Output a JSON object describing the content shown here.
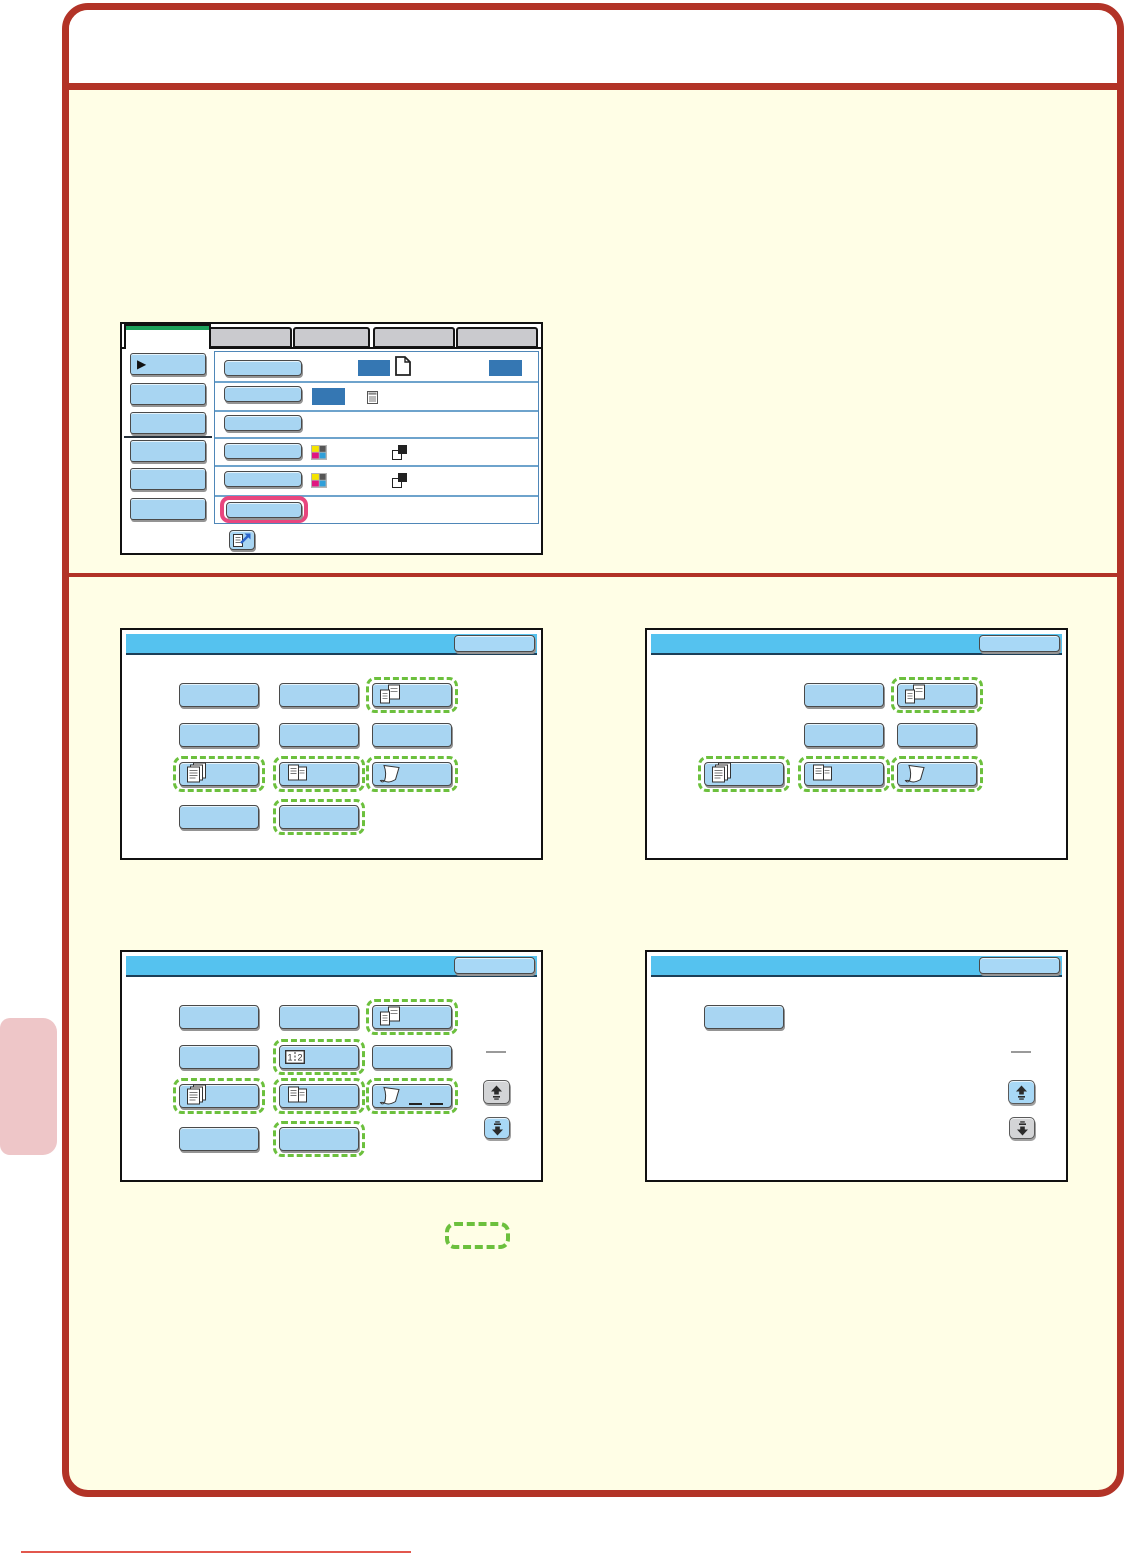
{
  "document": {
    "type": "copier-operation-manual-page",
    "header_title": "",
    "colors": {
      "red": "#b23327",
      "cream": "#fffee6",
      "sky": "#55c2ef",
      "btnblue": "#a8d5f2",
      "okblue": "#a8d8f6",
      "darkblue": "#3577b3",
      "tabgray": "#cacace",
      "green": "#1ca05a",
      "dashgreen": "#6cc03d",
      "pink": "#e8467e",
      "tabpink": "#eec6c8",
      "footer": "#e2574d",
      "disgray": "#d3d4d6"
    }
  },
  "settings_screen": {
    "tabs": [
      {
        "label": "",
        "active": true
      },
      {
        "label": "",
        "active": false
      },
      {
        "label": "",
        "active": false
      },
      {
        "label": "",
        "active": false
      },
      {
        "label": "",
        "active": false
      }
    ],
    "sidebar_keys": [
      {
        "label": "",
        "selected": true
      },
      {
        "label": ""
      },
      {
        "label": ""
      },
      {
        "label": ""
      },
      {
        "label": ""
      },
      {
        "label": ""
      }
    ],
    "rows": [
      {
        "key_label": "",
        "value_boxes": 2,
        "icons": [
          "blank-page"
        ]
      },
      {
        "key_label": "",
        "value_boxes": 1,
        "icons": [
          "document-list"
        ]
      },
      {
        "key_label": "",
        "value_boxes": 0,
        "icons": []
      },
      {
        "key_label": "",
        "value_boxes": 0,
        "icons": [
          "cmyk-squares",
          "bw-overlap-squares"
        ]
      },
      {
        "key_label": "",
        "value_boxes": 0,
        "icons": [
          "cmyk-squares",
          "bw-overlap-squares"
        ]
      },
      {
        "key_label": "",
        "value_boxes": 0,
        "icons": [],
        "highlighted": true
      }
    ],
    "program_key_icon": "register-program"
  },
  "panels": [
    {
      "id": "special-modes-1",
      "x": 120,
      "y": 628,
      "ok_label": "",
      "buttons": [
        {
          "row": 0,
          "col": 0
        },
        {
          "row": 0,
          "col": 1
        },
        {
          "row": 0,
          "col": 2,
          "dashed": true,
          "icon": "mixed-size-documents"
        },
        {
          "row": 1,
          "col": 0
        },
        {
          "row": 1,
          "col": 1
        },
        {
          "row": 1,
          "col": 2
        },
        {
          "row": 2,
          "col": 0,
          "dashed": true,
          "icon": "stacked-documents"
        },
        {
          "row": 2,
          "col": 1,
          "dashed": true,
          "icon": "document-pair"
        },
        {
          "row": 2,
          "col": 2,
          "dashed": true,
          "icon": "curled-sheet"
        },
        {
          "row": 3,
          "col": 0
        },
        {
          "row": 3,
          "col": 1,
          "dashed": true
        }
      ],
      "scroll": null
    },
    {
      "id": "special-modes-2",
      "x": 645,
      "y": 628,
      "ok_label": "",
      "buttons": [
        {
          "row": 0,
          "col": 1
        },
        {
          "row": 0,
          "col": 2,
          "dashed": true,
          "icon": "mixed-size-documents"
        },
        {
          "row": 1,
          "col": 1
        },
        {
          "row": 1,
          "col": 2
        },
        {
          "row": 2,
          "col": 0,
          "dashed": true,
          "icon": "stacked-documents"
        },
        {
          "row": 2,
          "col": 1,
          "dashed": true,
          "icon": "document-pair"
        },
        {
          "row": 2,
          "col": 2,
          "dashed": true,
          "icon": "curled-sheet"
        }
      ],
      "scroll": null
    },
    {
      "id": "special-modes-3-page1",
      "x": 120,
      "y": 950,
      "ok_label": "",
      "buttons": [
        {
          "row": 0,
          "col": 0
        },
        {
          "row": 0,
          "col": 1
        },
        {
          "row": 0,
          "col": 2,
          "dashed": true,
          "icon": "mixed-size-documents"
        },
        {
          "row": 1,
          "col": 0
        },
        {
          "row": 1,
          "col": 1,
          "dashed": true,
          "icon": "one-two-split"
        },
        {
          "row": 1,
          "col": 2
        },
        {
          "row": 2,
          "col": 0,
          "dashed": true,
          "icon": "stacked-documents"
        },
        {
          "row": 2,
          "col": 1,
          "dashed": true,
          "icon": "document-pair"
        },
        {
          "row": 2,
          "col": 2,
          "dashed": true,
          "icon": "curled-sheet",
          "marks": true
        },
        {
          "row": 3,
          "col": 0
        },
        {
          "row": 3,
          "col": 1,
          "dashed": true
        }
      ],
      "scroll": {
        "up_enabled": false,
        "down_enabled": true
      }
    },
    {
      "id": "special-modes-3-page2",
      "x": 645,
      "y": 950,
      "ok_label": "",
      "buttons": [
        {
          "row": 0,
          "col": 0
        }
      ],
      "scroll": {
        "up_enabled": true,
        "down_enabled": false
      }
    }
  ],
  "legend": {
    "label": "",
    "style": "green-dashed-outline"
  }
}
